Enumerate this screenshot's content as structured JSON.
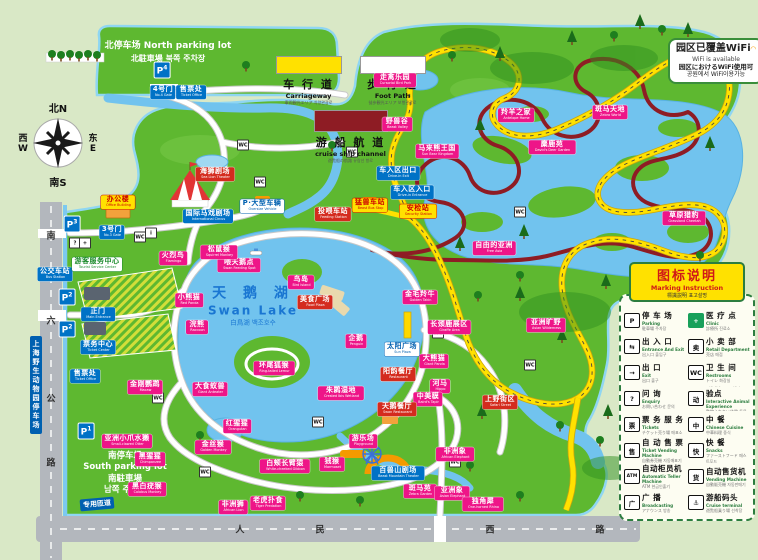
{
  "colors": {
    "park_green": "#5eb830",
    "bg_green": "#d9e8c6",
    "water": "#71c3ee",
    "carriageway": "#ffe100",
    "footpath": "#ffffff",
    "cruise": "#8e1c24",
    "label_pink": "#ee1588",
    "label_blue": "#0072c6",
    "label_red": "#d42b1e",
    "label_yellow": "#ffe100"
  },
  "north_parking": {
    "line1": "北停车场  North parking lot",
    "line2": "北駐車場  북쪽 주차장"
  },
  "south_parking": {
    "lines": [
      "南停车场",
      "South parking lot",
      "南駐車場",
      "남쪽 주차장"
    ]
  },
  "road_legend": {
    "items": [
      {
        "cn": "车 行 道",
        "en": "Carriageway",
        "sub": "車両観光エリア 차량관광로",
        "swatch": "#ffe100"
      },
      {
        "cn": "步 行 道",
        "en": "Foot Path",
        "sub": "徒歩観光エリア 보행관광로",
        "swatch": "#ffffff"
      },
      {
        "cn": "游 船 航 道",
        "en": "cruise ship channel",
        "sub": "遊覧船の航路 유람선 항로",
        "swatch": "#8e1c24"
      }
    ]
  },
  "wifi": {
    "line1": "园区已覆盖WiFi",
    "line2": "WiFi is available",
    "line3": "园区におけるWiFi使用可",
    "line4": "공원에서 WiFi이용가능"
  },
  "compass": {
    "north": "北N",
    "south": "南S",
    "west": "西",
    "west2": "W",
    "east": "东",
    "east2": "E"
  },
  "swan_lake": {
    "cn": "天 鹅 湖",
    "en": "Swan Lake",
    "sub": "白鳥湖  백조호수"
  },
  "legend_panel": {
    "title_cn": "图标说明",
    "title_en": "Marking Instruction",
    "title_sub": "標識説明  표고설명",
    "items": [
      {
        "icon": "P",
        "cn": "停 车 场",
        "en": "Parking",
        "sub": "駐車場 주차장"
      },
      {
        "icon": "+",
        "icon_bg": "#18a05a",
        "icon_fg": "#fff",
        "cn": "医 疗 点",
        "en": "Clinic",
        "sub": "診療所 진료소"
      },
      {
        "icon": "⇆",
        "cn": "出 入 口",
        "en": "Entrance And Exit",
        "sub": "出入口 출입구"
      },
      {
        "icon": "卖",
        "cn": "小 卖 部",
        "en": "Retail Department",
        "sub": "売店 매점"
      },
      {
        "icon": "→",
        "cn": "出  口",
        "en": "Exit",
        "sub": "出口 출구"
      },
      {
        "icon": "WC",
        "cn": "卫 生 间",
        "en": "Restrooms",
        "sub": "トイレ 화장실"
      },
      {
        "icon": "?",
        "cn": "问  询",
        "en": "Enquiry",
        "sub": "お問い合わせ 문의"
      },
      {
        "icon": "动",
        "cn": "动物互动体验点",
        "en": "Interactive Animal Experience",
        "sub": "動物ふれあい体験 동물체험"
      },
      {
        "icon": "票",
        "cn": "票 务 服 务",
        "en": "Tickets",
        "sub": "チケット売り場 매표소"
      },
      {
        "icon": "中",
        "cn": "中  餐",
        "en": "Chinese Cuisine",
        "sub": "中華料理 중식"
      },
      {
        "icon": "售",
        "cn": "自 动 售 票",
        "en": "Ticket Vending Machine",
        "sub": "自動券売機 자동매표기"
      },
      {
        "icon": "快",
        "cn": "快  餐",
        "en": "Snacks",
        "sub": "ファーストフード 패스트푸드"
      },
      {
        "icon": "ATM",
        "cn": "自动柜员机",
        "en": "Automatic Teller Machine",
        "sub": "ATM 현금인출기"
      },
      {
        "icon": "货",
        "cn": "自动售货机",
        "en": "Vending Machine",
        "sub": "自動販売機 자동판매기"
      },
      {
        "icon": "广",
        "cn": "广  播",
        "en": "Broadcasting",
        "sub": "アナウンス 방송"
      },
      {
        "icon": "⚓",
        "cn": "游船码头",
        "en": "Cruise terminal",
        "sub": "遊覧船乗り場 선착장"
      }
    ]
  },
  "signs": {
    "parking_vertical": "上海野生动物园停车场",
    "ramp": "专用匝道"
  },
  "roads": {
    "west_chars": [
      {
        "c": "南",
        "y": 235
      },
      {
        "c": "六",
        "y": 320
      },
      {
        "c": "公",
        "y": 398
      },
      {
        "c": "路",
        "y": 462
      }
    ],
    "south_chars": [
      {
        "c": "人",
        "x": 240
      },
      {
        "c": "民",
        "x": 320
      },
      {
        "c": "西",
        "x": 490
      },
      {
        "c": "路",
        "x": 600
      }
    ]
  },
  "p_badges": [
    {
      "x": 162,
      "y": 70,
      "num": "4"
    },
    {
      "x": 72,
      "y": 224,
      "num": "3"
    },
    {
      "x": 67,
      "y": 297,
      "num": "2"
    },
    {
      "x": 67,
      "y": 329,
      "num": "2"
    },
    {
      "x": 86,
      "y": 431,
      "num": "1"
    }
  ],
  "poi": [
    {
      "x": 75,
      "y": 243,
      "g": "?"
    },
    {
      "x": 85,
      "y": 243,
      "g": "+"
    },
    {
      "x": 140,
      "y": 237,
      "g": "WC"
    },
    {
      "x": 151,
      "y": 233,
      "g": "i"
    },
    {
      "x": 260,
      "y": 182,
      "g": "WC"
    },
    {
      "x": 352,
      "y": 152,
      "g": "WC"
    },
    {
      "x": 438,
      "y": 333,
      "g": "WC"
    },
    {
      "x": 318,
      "y": 422,
      "g": "WC"
    },
    {
      "x": 205,
      "y": 472,
      "g": "WC"
    },
    {
      "x": 520,
      "y": 212,
      "g": "WC"
    },
    {
      "x": 455,
      "y": 462,
      "g": "WC"
    },
    {
      "x": 158,
      "y": 398,
      "g": "WC"
    },
    {
      "x": 243,
      "y": 145,
      "g": "WC"
    },
    {
      "x": 530,
      "y": 365,
      "g": "WC"
    }
  ],
  "map_labels": [
    {
      "t": "pink",
      "x": 395,
      "y": 80,
      "cn": "走禽乐园",
      "en": "Cursorial Bird Park"
    },
    {
      "t": "pink",
      "x": 397,
      "y": 124,
      "cn": "野兽谷",
      "en": "Beast Valley"
    },
    {
      "t": "pink",
      "x": 437,
      "y": 151,
      "cn": "马来熊王国",
      "en": "Sun Bear Kingdom"
    },
    {
      "t": "pink",
      "x": 516,
      "y": 115,
      "cn": "羚羊之家",
      "en": "Antelope Home"
    },
    {
      "t": "pink",
      "x": 610,
      "y": 112,
      "cn": "斑马天地",
      "en": "Zebra World"
    },
    {
      "t": "pink",
      "x": 552,
      "y": 147,
      "cn": "麋鹿苑",
      "en": "David's Deer Garden"
    },
    {
      "t": "pink",
      "x": 684,
      "y": 218,
      "cn": "草原猎豹",
      "en": "Grassland Cheetah"
    },
    {
      "t": "pink",
      "x": 494,
      "y": 248,
      "cn": "自由的亚洲",
      "en": "Free Asia"
    },
    {
      "t": "pink",
      "x": 546,
      "y": 325,
      "cn": "亚洲旷野",
      "en": "Asian Wilderness"
    },
    {
      "t": "pink",
      "x": 449,
      "y": 327,
      "cn": "长颈鹿展区",
      "en": "Giraffe Area"
    },
    {
      "t": "pink",
      "x": 434,
      "y": 361,
      "cn": "大熊猫",
      "en": "Giant Panda"
    },
    {
      "t": "pink",
      "x": 440,
      "y": 386,
      "cn": "河马",
      "en": "Hippo"
    },
    {
      "t": "pink",
      "x": 428,
      "y": 399,
      "cn": "中美貘",
      "en": "Baird's Tapir"
    },
    {
      "t": "pink",
      "x": 420,
      "y": 297,
      "cn": "金毛羚牛",
      "en": "Golden Takin"
    },
    {
      "t": "pink",
      "x": 356,
      "y": 341,
      "cn": "企鹅",
      "en": "Penguin"
    },
    {
      "t": "pink",
      "x": 341,
      "y": 393,
      "cn": "朱鹮湿地",
      "en": "Crested Ibis Wetland"
    },
    {
      "t": "pink",
      "x": 301,
      "y": 282,
      "cn": "鸟岛",
      "en": "Bird Island"
    },
    {
      "t": "pink",
      "x": 274,
      "y": 368,
      "cn": "环尾狐猴",
      "en": "Ring-tailed Lemur"
    },
    {
      "t": "pink",
      "x": 239,
      "y": 265,
      "cn": "喂天鹅点",
      "en": "Swan Feeding Spot"
    },
    {
      "t": "pink",
      "x": 189,
      "y": 300,
      "cn": "小熊猫",
      "en": "Red Panda"
    },
    {
      "t": "pink",
      "x": 173,
      "y": 258,
      "cn": "火烈鸟",
      "en": "Flamingo"
    },
    {
      "t": "pink",
      "x": 219,
      "y": 252,
      "cn": "松鼠猴",
      "en": "Squirrel Monkey"
    },
    {
      "t": "pink",
      "x": 197,
      "y": 327,
      "cn": "浣熊",
      "en": "Raccoon"
    },
    {
      "t": "pink",
      "x": 210,
      "y": 389,
      "cn": "大食蚁兽",
      "en": "Giant Anteater"
    },
    {
      "t": "pink",
      "x": 145,
      "y": 387,
      "cn": "金刚鹦鹉",
      "en": "Macaw"
    },
    {
      "t": "pink",
      "x": 127,
      "y": 441,
      "cn": "亚洲小爪水獭",
      "en": "Small-clawed Otter"
    },
    {
      "t": "pink",
      "x": 150,
      "y": 459,
      "cn": "黑猩猩",
      "en": "Chimpanzee"
    },
    {
      "t": "pink",
      "x": 147,
      "y": 489,
      "cn": "黑白疣猴",
      "en": "Colobus Monkey"
    },
    {
      "t": "pink",
      "x": 213,
      "y": 447,
      "cn": "金丝猴",
      "en": "Golden Monkey"
    },
    {
      "t": "pink",
      "x": 237,
      "y": 426,
      "cn": "红猩猩",
      "en": "Orangutan"
    },
    {
      "t": "pink",
      "x": 285,
      "y": 466,
      "cn": "白颊长臂猿",
      "en": "White-cheeked Gibbon"
    },
    {
      "t": "pink",
      "x": 332,
      "y": 464,
      "cn": "狨猴",
      "en": "Marmoset"
    },
    {
      "t": "pink",
      "x": 363,
      "y": 441,
      "cn": "游乐场",
      "en": "Playground"
    },
    {
      "t": "pink",
      "x": 233,
      "y": 507,
      "cn": "非洲狮",
      "en": "African Lion"
    },
    {
      "t": "pink",
      "x": 268,
      "y": 503,
      "cn": "老虎扑食",
      "en": "Tiger Predation"
    },
    {
      "t": "pink",
      "x": 420,
      "y": 491,
      "cn": "斑马苑",
      "en": "Zebra Garden"
    },
    {
      "t": "pink",
      "x": 452,
      "y": 493,
      "cn": "亚洲象",
      "en": "Asian Elephant"
    },
    {
      "t": "pink",
      "x": 455,
      "y": 454,
      "cn": "非洲象",
      "en": "African Elephant"
    },
    {
      "t": "pink",
      "x": 483,
      "y": 504,
      "cn": "独角犀",
      "en": "One-horned Rhino"
    },
    {
      "t": "red",
      "x": 215,
      "y": 174,
      "cn": "海狮剧场",
      "en": "Sea Lion Theater"
    },
    {
      "t": "red",
      "x": 315,
      "y": 302,
      "cn": "美食广场",
      "en": "Food Plaza"
    },
    {
      "t": "red",
      "x": 398,
      "y": 374,
      "cn": "阳韵餐厅",
      "en": "Restaurant"
    },
    {
      "t": "red",
      "x": 397,
      "y": 409,
      "cn": "天鹅餐厅",
      "en": "Swan Restaurant"
    },
    {
      "t": "red",
      "x": 500,
      "y": 402,
      "cn": "上野街区",
      "en": "Safari Street"
    },
    {
      "t": "red",
      "x": 333,
      "y": 214,
      "cn": "投喂车站",
      "en": "Feeding Station"
    },
    {
      "t": "blue",
      "x": 163,
      "y": 92,
      "cn": "4号门",
      "en": "No.4 Gate"
    },
    {
      "t": "blue",
      "x": 191,
      "y": 92,
      "cn": "售票处",
      "en": "Ticket Office"
    },
    {
      "t": "blue",
      "x": 112,
      "y": 232,
      "cn": "3号门",
      "en": "No.3 Gate"
    },
    {
      "t": "blue",
      "x": 98,
      "y": 314,
      "cn": "正门",
      "en": "Main Entrance"
    },
    {
      "t": "blue",
      "x": 98,
      "y": 347,
      "cn": "票务中心",
      "en": "Ticket Center"
    },
    {
      "t": "blue",
      "x": 85,
      "y": 376,
      "cn": "售票处",
      "en": "Ticket Office"
    },
    {
      "t": "blue",
      "x": 55,
      "y": 274,
      "cn": "公交车站",
      "en": "Bus Station"
    },
    {
      "t": "blue",
      "x": 398,
      "y": 173,
      "cn": "车入区出口",
      "en": "Drive-in Exit"
    },
    {
      "t": "blue",
      "x": 412,
      "y": 192,
      "cn": "车入区入口",
      "en": "Drive-in Entrance"
    },
    {
      "t": "blue",
      "x": 208,
      "y": 216,
      "cn": "国际马戏剧场",
      "en": "International Circus"
    },
    {
      "t": "blue",
      "x": 398,
      "y": 473,
      "cn": "百兽山剧场",
      "en": "Beast Mountain Theater"
    },
    {
      "t": "yellow",
      "x": 118,
      "y": 202,
      "cn": "办公楼",
      "en": "Office Building"
    },
    {
      "t": "yellow",
      "x": 418,
      "y": 211,
      "cn": "安检站",
      "en": "Security Station"
    },
    {
      "t": "yellow",
      "x": 370,
      "y": 205,
      "cn": "猛兽车站",
      "en": "Beast Bus Stop"
    },
    {
      "t": "green",
      "x": 97,
      "y": 264,
      "cn": "游客服务中心",
      "en": "Tourist Service Center"
    },
    {
      "t": "white",
      "x": 402,
      "y": 349,
      "cn": "太阳广场",
      "en": "Sun Plaza"
    },
    {
      "t": "white",
      "x": 262,
      "y": 206,
      "cn": "P·大型车辆",
      "en": "Oversize Vehicle"
    }
  ]
}
